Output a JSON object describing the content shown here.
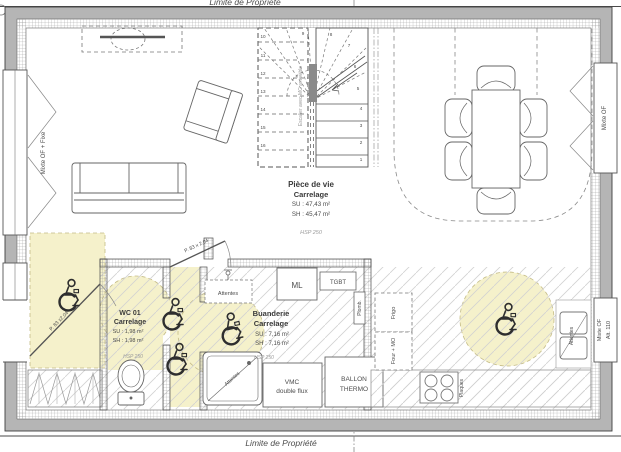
{
  "property": {
    "top": "Limite de Propriété",
    "bottom": "Limite de Propriété"
  },
  "rooms": {
    "living": {
      "name": "Pièce de vie",
      "finish": "Carrelage",
      "su": "SU : 47,43 m²",
      "sh": "SH : 45,47 m²",
      "hsp": "HSP 250"
    },
    "wc": {
      "name": "WC 01",
      "finish": "Carrelage",
      "su": "SU : 1,98 m²",
      "sh": "SH : 1,98 m²",
      "hsp": "HSP 250"
    },
    "laundry": {
      "name": "Buanderie",
      "finish": "Carrelage",
      "su": "SU : 7,16 m²",
      "sh": "SH : 7,16 m²",
      "hsp": "HSP 250"
    }
  },
  "windows": {
    "left": "Mixte OF + Fixe",
    "right_top": "Mixte OF",
    "right_bottom_line1": "Mixte OF",
    "right_bottom_line2": "Alt. 110"
  },
  "doors": {
    "entry": "P. 83 x2,04",
    "hall": "P. 83 x 2,04"
  },
  "equipment": {
    "attentes_plumb": "Attentes",
    "attentes_shower": "Attentes",
    "attentes_sink": "Attentes",
    "ml": "ML",
    "tgbt": "TGBT",
    "plomb": "Plomb.",
    "frigo": "Frigo",
    "four_mo": "Four + MO",
    "ballon_line1": "BALLON",
    "ballon_line2": "THERMO",
    "vmc_line1": "VMC",
    "vmc_line2": "double flux",
    "plaques": "Plaques"
  },
  "stairs": {
    "note": "Escalier avec MC amovible",
    "steps": [
      "1",
      "2",
      "3",
      "4",
      "5",
      "6",
      "7",
      "8",
      "9",
      "10",
      "11",
      "12",
      "13",
      "14",
      "15",
      "16"
    ]
  },
  "colors": {
    "zone_yellow": "#f5f1cb",
    "wall_gray": "#b5b5b5"
  }
}
